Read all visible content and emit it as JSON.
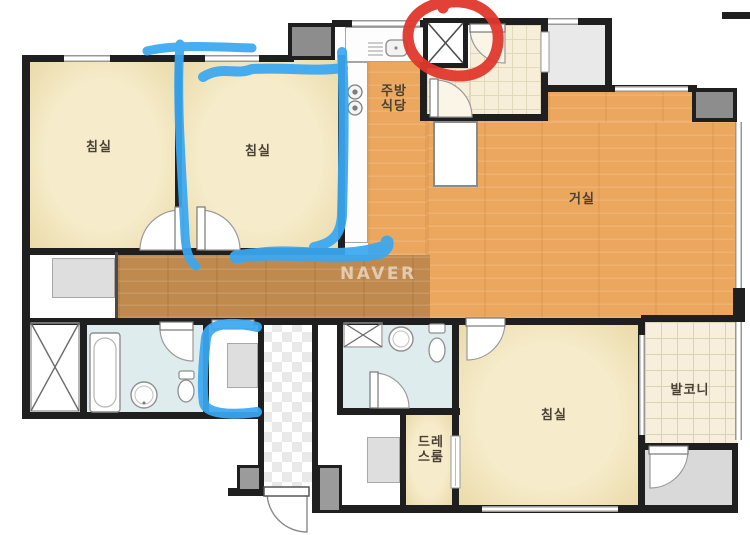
{
  "floorplan": {
    "watermark": "NAVER",
    "labels": {
      "bedroom1": "침실",
      "bedroom2": "침실",
      "bedroom3": "침실",
      "living": "거실",
      "kitchen_line1": "주방",
      "kitchen_line2": "식당",
      "balcony": "발코니",
      "dressroom_line1": "드레",
      "dressroom_line2": "스룸"
    },
    "colors": {
      "marker_blue": "#3aa8f2",
      "marker_red": "#e0372c",
      "wood_living": "#eca75f",
      "wood_hallway": "#c08a4e",
      "floor_cream": "#f3e9c6",
      "floor_bath": "#dfecee",
      "floor_tile": "#f6eed9",
      "wall": "#1f1f1f"
    }
  }
}
